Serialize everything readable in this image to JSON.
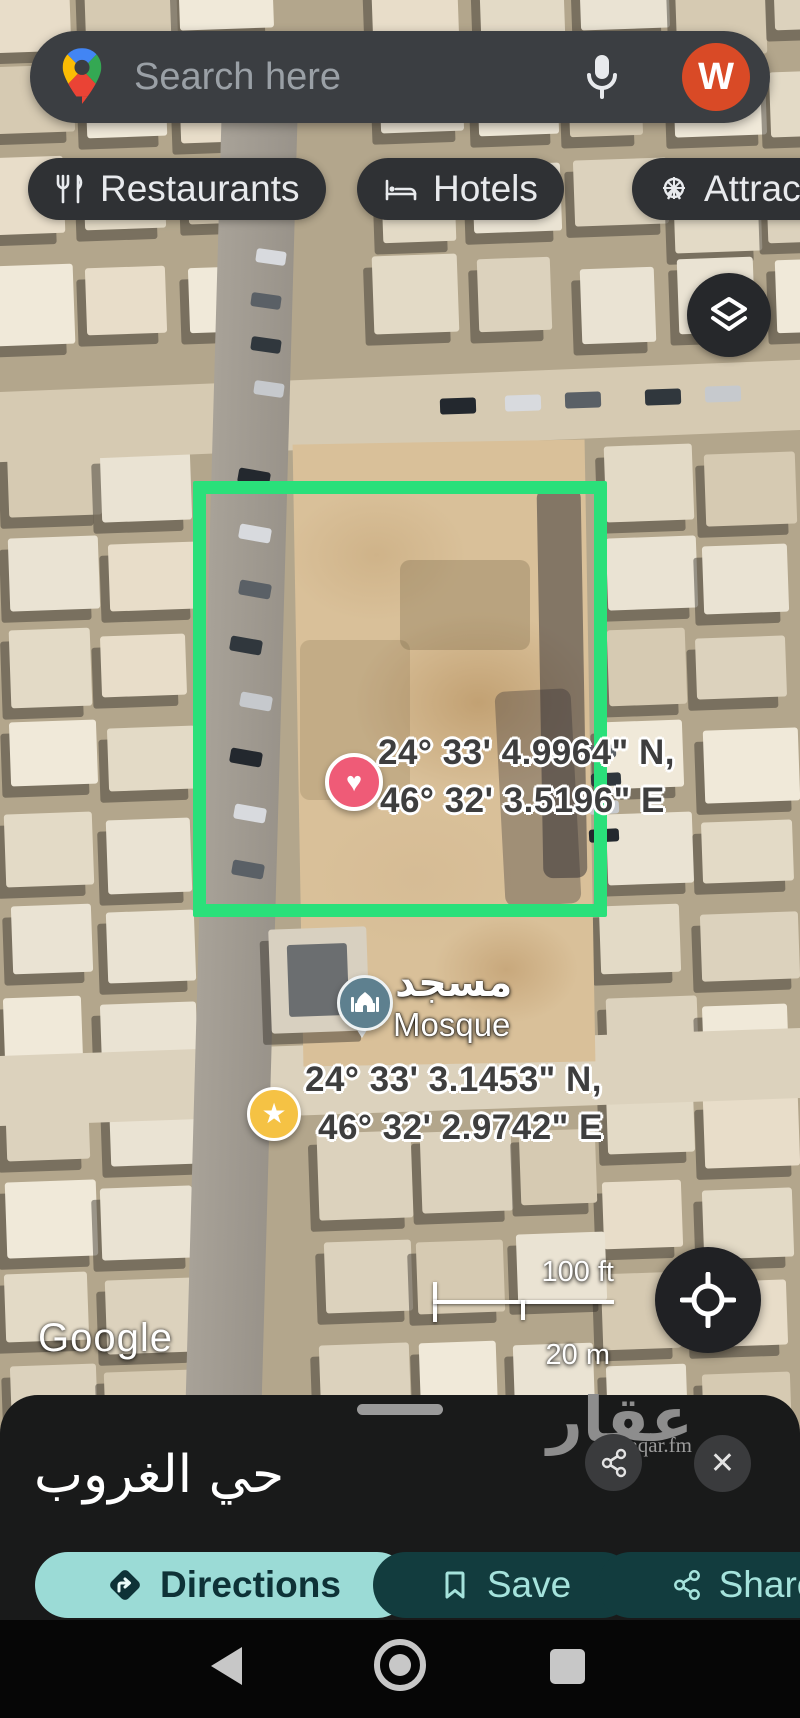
{
  "search": {
    "placeholder": "Search here",
    "avatar_letter": "W"
  },
  "chips": [
    {
      "label": "Restaurants",
      "icon": "fork-knife-icon"
    },
    {
      "label": "Hotels",
      "icon": "bed-icon"
    },
    {
      "label": "Attractions",
      "icon": "ferris-wheel-icon"
    }
  ],
  "map": {
    "watermark": "Google",
    "scale": {
      "imperial": "100 ft",
      "metric": "20 m"
    },
    "markers": {
      "heart": {
        "glyph": "♥",
        "line1": "24° 33' 4.9964\" N,",
        "line2": "46° 32' 3.5196\" E"
      },
      "mosque": {
        "label_ar": "مسجد",
        "label_en": "Mosque"
      },
      "star": {
        "glyph": "★",
        "line1": "24° 33' 3.1453\" N,",
        "line2": "46° 32' 2.9742\" E"
      }
    }
  },
  "sheet": {
    "title": "حي الغروب",
    "close_glyph": "✕",
    "watermark": {
      "brand": "عقار",
      "domain": "sa.aqar.fm"
    },
    "actions": {
      "directions": "Directions",
      "save": "Save",
      "share": "Share"
    }
  },
  "icons": {
    "logo": "google-maps-pin",
    "mic": "microphone",
    "layers": "map-layers",
    "locate": "my-location-crosshair",
    "share_small": "share-nodes",
    "close": "x",
    "directions": "diamond-turn-right",
    "save": "bookmark",
    "share": "share-nodes",
    "nav": [
      "triangle-back",
      "circle-home",
      "square-recents"
    ]
  },
  "colors": {
    "plot_outline": "#2ae07a",
    "heart_pin": "#ef5b77",
    "star_pin": "#f5c244",
    "mosque_pin": "#5e808f",
    "avatar": "#d94a26",
    "chip_bg": "#2f3134",
    "search_bg": "#3b3e42",
    "directions_bg": "#9bdbd6",
    "action_bg": "#123c3e",
    "action_fg": "#a5e3dc",
    "sheet_bg": "#191a1a"
  }
}
